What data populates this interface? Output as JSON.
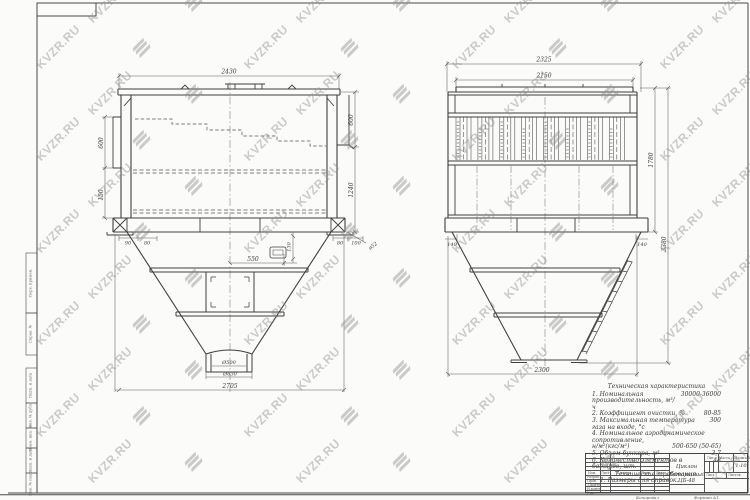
{
  "watermark": {
    "text": "KVZR.RU"
  },
  "margin_stamps": {
    "top": [
      "Перв. примен.",
      "Справ. №"
    ],
    "bottom": [
      "Подп. и дата",
      "Инв. № дубл.",
      "Взам. инв. №",
      "Подп. и дата",
      "Инв. № подл."
    ]
  },
  "front_view": {
    "dim_width_top": "2430",
    "dim_left_upper": "600",
    "dim_left_lower": "150",
    "dim_right_upper": "600",
    "dim_right_lower": "1240",
    "dim_foot_left_1": "90",
    "dim_foot_left_2": "80",
    "dim_foot_right_1": "80",
    "dim_foot_right_2": "100",
    "dim_anchor": "ø52",
    "dim_hatch": "550",
    "dim_sensor": "130",
    "dim_outlet": "Ø500",
    "dim_outlet_flange": "Ø630",
    "dim_width_bottom": "2705"
  },
  "side_view": {
    "dim_width_top": "2325",
    "dim_width_inner": "2150",
    "dim_height_body": "1780",
    "dim_height_total": "3380",
    "dim_width_bottom": "2300",
    "dim_corner_left": "140",
    "dim_corner_right": "140"
  },
  "tech_chars": {
    "title": "Техническая характеристика",
    "items": [
      {
        "text": "1. Номинальная производительность, м³/ч",
        "value": "30000-36000"
      },
      {
        "text": "2. Коэффициент очистки, %",
        "value": "80-85"
      },
      {
        "text": "3. Максимальная температура газа на входе, °с",
        "value": "300"
      },
      {
        "text": "4. Номинальное аэродинамическое сопротивление,",
        "value": ""
      },
      {
        "text": "н/м²(кгс/м²)",
        "value": "500-650 (50-65)"
      },
      {
        "text": "5. Объем бункера, м³",
        "value": "3,7"
      },
      {
        "text": "6. Количество элементов в батарее, шт.",
        "value": "48"
      }
    ],
    "req_title": "Технические требования.",
    "req_item": "1. Размеры для справок."
  },
  "title_block": {
    "name_line1": "Циклон",
    "name_line2": "Батарейный ЦБ-48",
    "header_cells": [
      "Изм.",
      "Лист",
      "№ докум.",
      "Подп.",
      "Дата"
    ],
    "staff_rows": [
      "Разраб.",
      "Пров.",
      "Т.контр.",
      "Н.контр.",
      "Утв."
    ],
    "col_lit": "Лит.",
    "col_mass": "Масса",
    "col_scale": "Масштаб",
    "scale_value": "1:10",
    "sheet_label": "Лист",
    "sheets_label": "Листов",
    "copied_label": "Копировал",
    "format_label": "Формат А1"
  }
}
